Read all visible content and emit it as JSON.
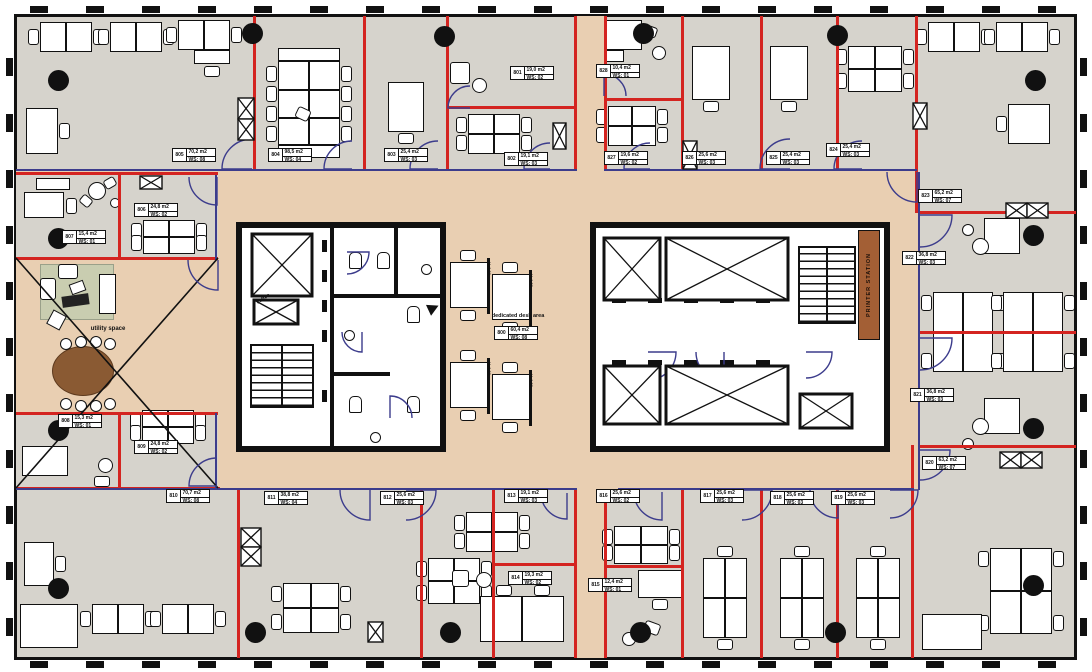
{
  "rooms": [
    {
      "id": "800",
      "area": "60,4 m2",
      "ws": "WS: 08"
    },
    {
      "id": "801",
      "area": "19,0 m2",
      "ws": "WS: 02"
    },
    {
      "id": "802",
      "area": "19,1 m2",
      "ws": "WS: 03"
    },
    {
      "id": "803",
      "area": "25,4 m2",
      "ws": "WS: 03"
    },
    {
      "id": "804",
      "area": "98,5 m2",
      "ws": "WS: 04"
    },
    {
      "id": "805",
      "area": "70,2 m2",
      "ws": "WS: 08"
    },
    {
      "id": "806",
      "area": "24,8 m2",
      "ws": "WS: 02"
    },
    {
      "id": "807",
      "area": "15,4 m2",
      "ws": "WS: 01"
    },
    {
      "id": "808",
      "area": "15,3 m2",
      "ws": "WS: 01"
    },
    {
      "id": "809",
      "area": "24,8 m2",
      "ws": "WS: 02"
    },
    {
      "id": "810",
      "area": "70,7 m2",
      "ws": "WS: 08"
    },
    {
      "id": "811",
      "area": "38,8 m2",
      "ws": "WS: 04"
    },
    {
      "id": "812",
      "area": "25,6 m2",
      "ws": "WS: 03"
    },
    {
      "id": "813",
      "area": "19,1 m2",
      "ws": "WS: 03"
    },
    {
      "id": "814",
      "area": "19,3 m2",
      "ws": "WS: 02"
    },
    {
      "id": "815",
      "area": "12,4 m2",
      "ws": "WS: 01"
    },
    {
      "id": "816",
      "area": "25,6 m2",
      "ws": "WS: 02"
    },
    {
      "id": "817",
      "area": "25,6 m2",
      "ws": "WS: 03"
    },
    {
      "id": "818",
      "area": "25,6 m2",
      "ws": "WS: 03"
    },
    {
      "id": "819",
      "area": "25,6 m2",
      "ws": "WS: 03"
    },
    {
      "id": "820",
      "area": "63,2 m2",
      "ws": "WS: 07"
    },
    {
      "id": "821",
      "area": "36,8 m2",
      "ws": "WS: 03"
    },
    {
      "id": "822",
      "area": "36,8 m2",
      "ws": "WS: 03"
    },
    {
      "id": "823",
      "area": "65,2 m2",
      "ws": "WS: 07"
    },
    {
      "id": "824",
      "area": "25,4 m2",
      "ws": "WS: 03"
    },
    {
      "id": "825",
      "area": "25,4 m2",
      "ws": "WS: 03"
    },
    {
      "id": "826",
      "area": "25,6 m2",
      "ws": "WS: 03"
    },
    {
      "id": "827",
      "area": "19,6 m2",
      "ws": "WS: 02"
    },
    {
      "id": "828",
      "area": "10,4 m2",
      "ws": "WS: 01"
    }
  ],
  "texts": {
    "utility_space": "utility space",
    "dedicated_desk_area": "dedicated desk area",
    "printer_station": "PRINTER STATION",
    "coffee": "coffee",
    "desk_height": "H=1,86"
  },
  "colors": {
    "open_floor": "#d6d3cc",
    "open_space_tan": "#e9cfb2",
    "wall_red": "#d42420",
    "partition_blue": "#3c3c8c",
    "core_black": "#111111",
    "printer_brown": "#a35f35",
    "rug_green": "#c9cdb0",
    "table_brown": "#8a5a33"
  }
}
